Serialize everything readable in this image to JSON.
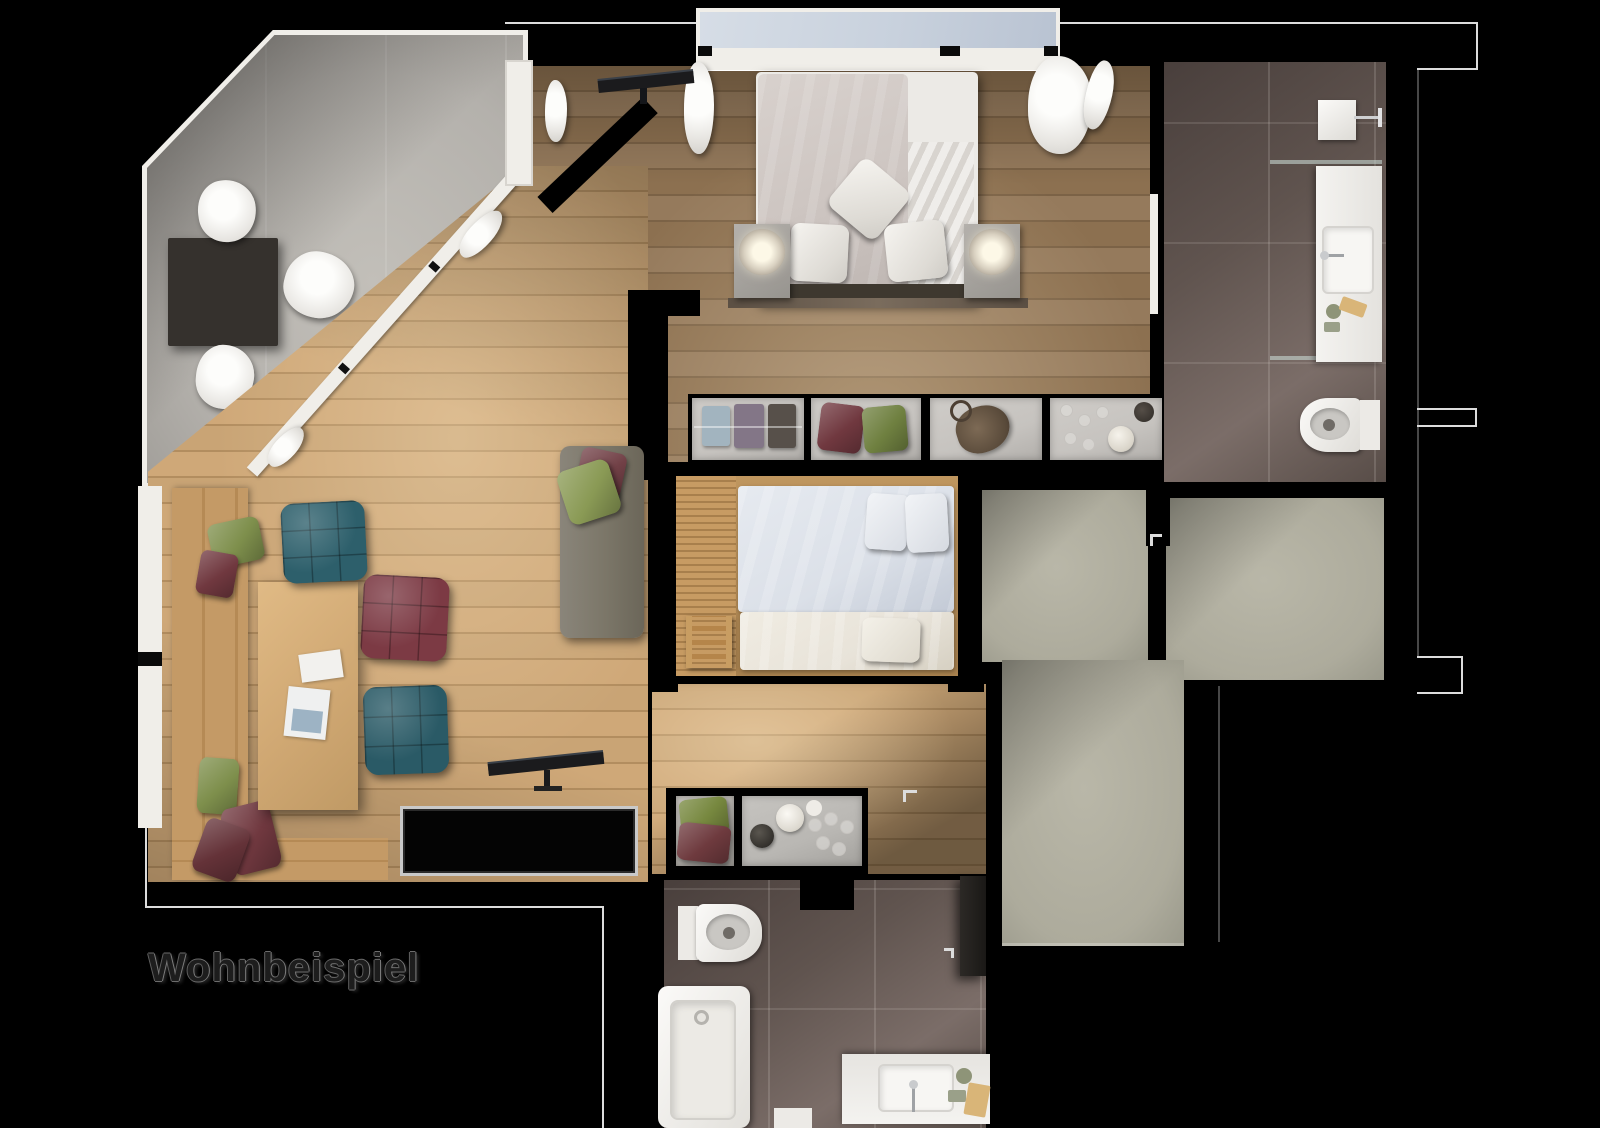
{
  "caption": {
    "text": "Wohnbeispiel"
  },
  "palette": {
    "background": "#000000",
    "stone_floor": "#b4b1ac",
    "wood_light": "#c9a475",
    "wood_light_dark": "#b28d5f",
    "wood_medium": "#8c7050",
    "wood_medium_dark": "#7b6246",
    "bench_wood": "#c49a66",
    "table_dark": "#35312d",
    "tile_floor": "#60544f",
    "tile_light": "#7b6d68",
    "hallway_floor": "#adab9c",
    "window_glass": "#c8d1dd",
    "frame_white": "#f0eee9",
    "outline_white": "#dcdcdc",
    "duvet_gray": "#cdc5c1",
    "mattress_white": "#eceae6",
    "kids_duvet": "#dbe0e8",
    "trundle_cream": "#e8e3d9",
    "sofa_gray": "#7b7668",
    "pouf_teal": "#2d5f6b",
    "pouf_maroon": "#7c3a44",
    "pillow_green": "#7e8f4c",
    "pillow_maroon": "#70383f",
    "compartment_gray": "#c6c3bf",
    "counter_gray": "#b9b7b3",
    "tv_black": "#1b1b1d",
    "lamp_glow": "#fdf8e7",
    "caption_color": "#1d1d1d",
    "caption_outline": "#7d7d7d"
  }
}
